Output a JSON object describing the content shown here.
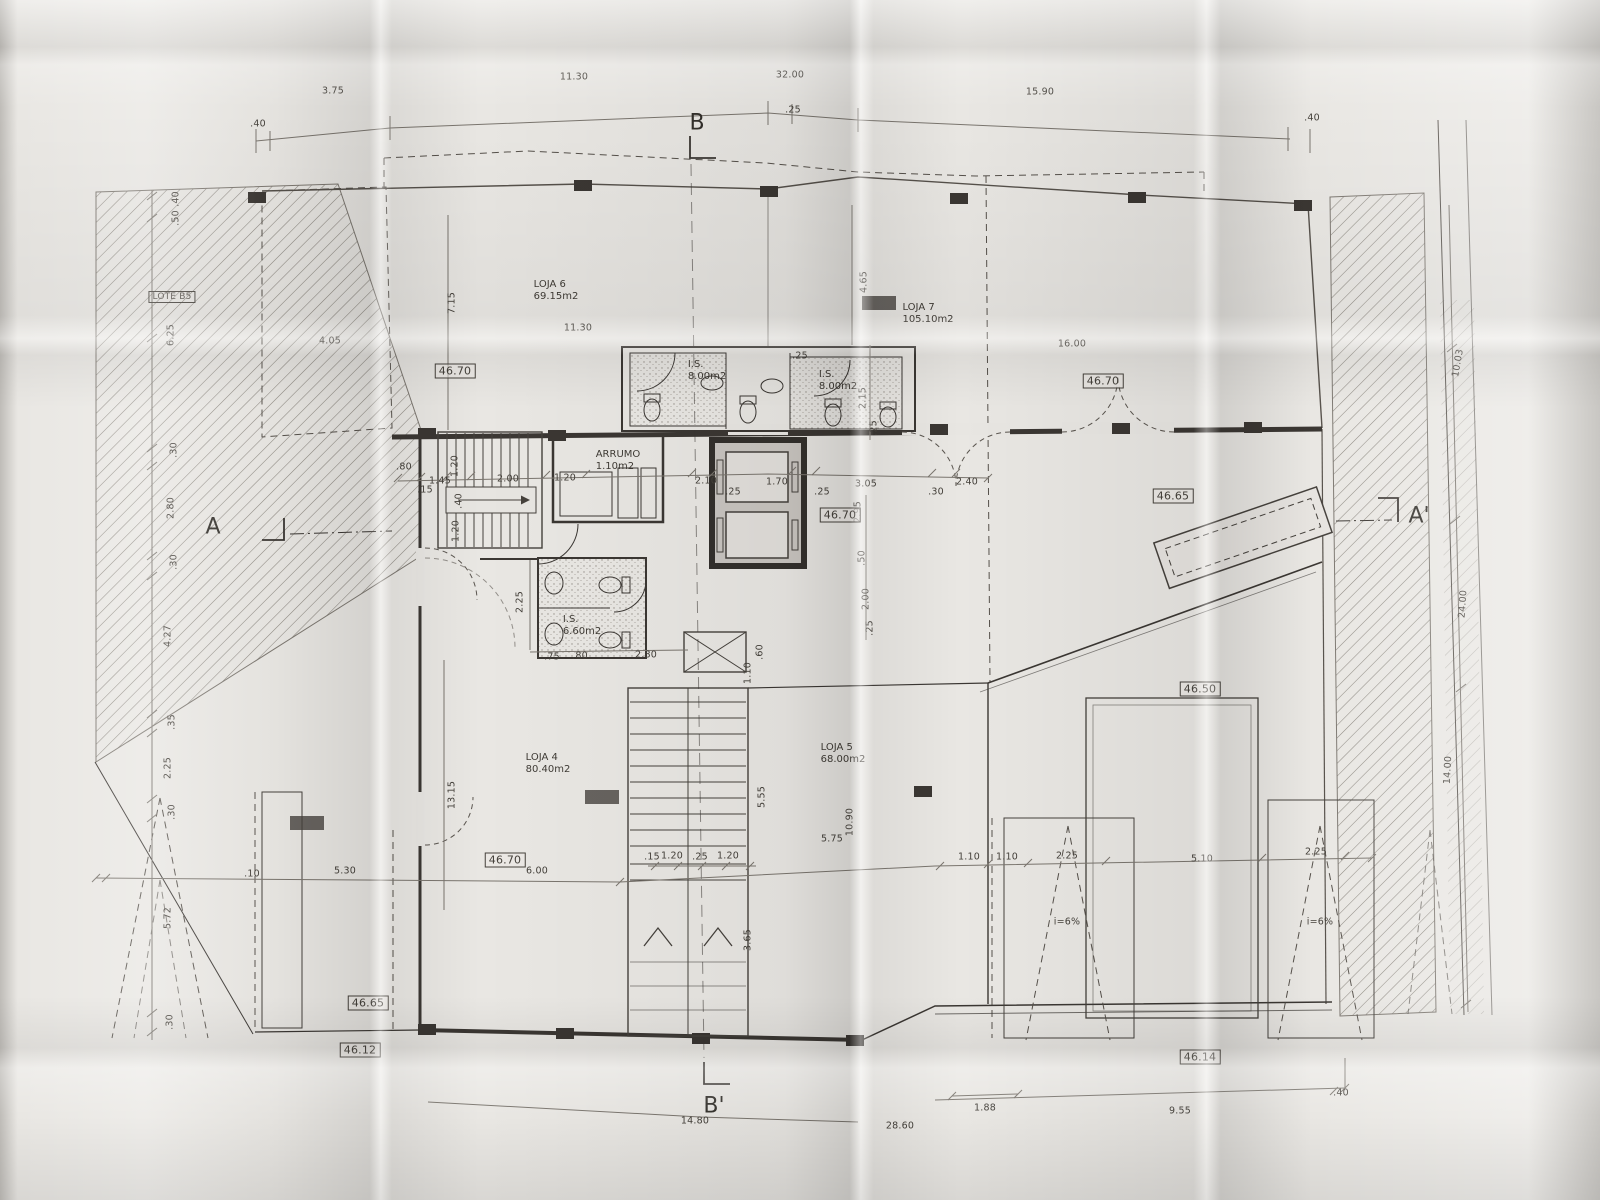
{
  "document": {
    "type": "architectural-floor-plan",
    "description": "Photographed fold-out blueprint, ground floor plan with shops (lojas), WCs, stairs, elevators and ramps"
  },
  "section_markers": [
    {
      "label": "B",
      "x": 697,
      "y": 123
    },
    {
      "label": "B'",
      "x": 714,
      "y": 1106
    },
    {
      "label": "A",
      "x": 213,
      "y": 527
    },
    {
      "label": "A'",
      "x": 1419,
      "y": 516
    }
  ],
  "lot_label": {
    "text": "LOTE B5",
    "x": 172,
    "y": 297
  },
  "room_labels": [
    {
      "name": "LOJA 6",
      "area": "69.15m2",
      "x": 556,
      "y": 291
    },
    {
      "name": "LOJA 7",
      "area": "105.10m2",
      "x": 928,
      "y": 314
    },
    {
      "name": "LOJA 4",
      "area": "80.40m2",
      "x": 548,
      "y": 764
    },
    {
      "name": "LOJA 5",
      "area": "68.00m2",
      "x": 843,
      "y": 754
    },
    {
      "name": "I.S.",
      "area": "8.00m2",
      "x": 707,
      "y": 371
    },
    {
      "name": "I.S.",
      "area": "8.00m2",
      "x": 838,
      "y": 381
    },
    {
      "name": "I.S.",
      "area": "6.60m2",
      "x": 582,
      "y": 626
    },
    {
      "name": "ARRUMO",
      "area": "1.10m2",
      "x": 618,
      "y": 461
    }
  ],
  "elevation_labels": [
    {
      "text": "46.70",
      "x": 455,
      "y": 371
    },
    {
      "text": "46.70",
      "x": 1103,
      "y": 381
    },
    {
      "text": "46.65",
      "x": 1173,
      "y": 496
    },
    {
      "text": "46.70",
      "x": 840,
      "y": 515
    },
    {
      "text": "46.50",
      "x": 1200,
      "y": 689
    },
    {
      "text": "46.70",
      "x": 505,
      "y": 860
    },
    {
      "text": "46.65",
      "x": 368,
      "y": 1003
    },
    {
      "text": "46.12",
      "x": 360,
      "y": 1050
    },
    {
      "text": "46.14",
      "x": 1200,
      "y": 1057
    }
  ],
  "slope_labels": [
    {
      "text": "i=6%",
      "x": 1067,
      "y": 922
    },
    {
      "text": "i=6%",
      "x": 1320,
      "y": 922
    }
  ],
  "dimensions": [
    {
      "t": ".40",
      "x": 258,
      "y": 124,
      "r": 0
    },
    {
      "t": "3.75",
      "x": 333,
      "y": 91,
      "r": 0
    },
    {
      "t": "11.30",
      "x": 574,
      "y": 77,
      "r": 0
    },
    {
      "t": "32.00",
      "x": 790,
      "y": 75,
      "r": 0
    },
    {
      "t": ".25",
      "x": 793,
      "y": 110,
      "r": 0
    },
    {
      "t": "15.90",
      "x": 1040,
      "y": 92,
      "r": 0
    },
    {
      "t": ".40",
      "x": 1312,
      "y": 118,
      "r": 0
    },
    {
      "t": ".40",
      "x": 176,
      "y": 199,
      "r": -90
    },
    {
      "t": ".50",
      "x": 176,
      "y": 218,
      "r": -90
    },
    {
      "t": "6.25",
      "x": 171,
      "y": 335,
      "r": -90
    },
    {
      "t": ".30",
      "x": 174,
      "y": 450,
      "r": -90
    },
    {
      "t": "2.80",
      "x": 171,
      "y": 508,
      "r": -90
    },
    {
      "t": ".30",
      "x": 174,
      "y": 562,
      "r": -90
    },
    {
      "t": "4.27",
      "x": 168,
      "y": 636,
      "r": -90
    },
    {
      "t": ".35",
      "x": 172,
      "y": 722,
      "r": -90
    },
    {
      "t": "2.25",
      "x": 168,
      "y": 768,
      "r": -90
    },
    {
      "t": ".30",
      "x": 172,
      "y": 812,
      "r": -90
    },
    {
      "t": "5.72",
      "x": 168,
      "y": 918,
      "r": -90
    },
    {
      "t": ".30",
      "x": 170,
      "y": 1022,
      "r": -90
    },
    {
      "t": "7.15",
      "x": 452,
      "y": 303,
      "r": -90
    },
    {
      "t": "4.05",
      "x": 330,
      "y": 341,
      "r": 0
    },
    {
      "t": "11.30",
      "x": 578,
      "y": 328,
      "r": 0
    },
    {
      "t": "4.65",
      "x": 864,
      "y": 282,
      "r": -90
    },
    {
      "t": "16.00",
      "x": 1072,
      "y": 344,
      "r": 0
    },
    {
      "t": ".25",
      "x": 800,
      "y": 356,
      "r": 0
    },
    {
      "t": "2.15",
      "x": 863,
      "y": 398,
      "r": -90
    },
    {
      "t": ".25",
      "x": 874,
      "y": 428,
      "r": -90
    },
    {
      "t": ".80",
      "x": 404,
      "y": 467,
      "r": 0
    },
    {
      "t": "1.45",
      "x": 440,
      "y": 481,
      "r": 0
    },
    {
      "t": ".15",
      "x": 425,
      "y": 490,
      "r": 0
    },
    {
      "t": "1.20",
      "x": 455,
      "y": 466,
      "r": -90
    },
    {
      "t": "2.00",
      "x": 508,
      "y": 479,
      "r": 0
    },
    {
      "t": ".40",
      "x": 459,
      "y": 501,
      "r": -90
    },
    {
      "t": "1.20",
      "x": 456,
      "y": 531,
      "r": -90
    },
    {
      "t": "1.20",
      "x": 565,
      "y": 478,
      "r": 0
    },
    {
      "t": "2.10",
      "x": 706,
      "y": 481,
      "r": 0
    },
    {
      "t": ".25",
      "x": 733,
      "y": 492,
      "r": 0
    },
    {
      "t": "1.70",
      "x": 777,
      "y": 482,
      "r": 0
    },
    {
      "t": ".25",
      "x": 822,
      "y": 492,
      "r": 0
    },
    {
      "t": "3.05",
      "x": 866,
      "y": 484,
      "r": 0
    },
    {
      "t": ".30",
      "x": 936,
      "y": 492,
      "r": 0
    },
    {
      "t": "2.40",
      "x": 967,
      "y": 482,
      "r": 0
    },
    {
      "t": "2.95",
      "x": 858,
      "y": 512,
      "r": -90
    },
    {
      "t": ".50",
      "x": 862,
      "y": 558,
      "r": -90
    },
    {
      "t": "2.00",
      "x": 866,
      "y": 599,
      "r": -90
    },
    {
      "t": ".25",
      "x": 870,
      "y": 628,
      "r": -90
    },
    {
      "t": "2.25",
      "x": 520,
      "y": 602,
      "r": -90
    },
    {
      "t": ".75",
      "x": 552,
      "y": 657,
      "r": 0
    },
    {
      "t": ".80",
      "x": 580,
      "y": 656,
      "r": 0
    },
    {
      "t": "2.80",
      "x": 646,
      "y": 655,
      "r": 0
    },
    {
      "t": ".60",
      "x": 760,
      "y": 652,
      "r": -90
    },
    {
      "t": "1.10",
      "x": 748,
      "y": 673,
      "r": -90
    },
    {
      "t": "5.55",
      "x": 762,
      "y": 797,
      "r": -90
    },
    {
      "t": "10.90",
      "x": 850,
      "y": 822,
      "r": -90
    },
    {
      "t": "5.75",
      "x": 832,
      "y": 839,
      "r": 0
    },
    {
      "t": "13.15",
      "x": 452,
      "y": 795,
      "r": -90
    },
    {
      "t": "3.65",
      "x": 748,
      "y": 940,
      "r": -90
    },
    {
      "t": ".15",
      "x": 652,
      "y": 857,
      "r": 0
    },
    {
      "t": "1.20",
      "x": 672,
      "y": 856,
      "r": 0
    },
    {
      "t": ".25",
      "x": 700,
      "y": 857,
      "r": 0
    },
    {
      "t": "1.20",
      "x": 728,
      "y": 856,
      "r": 0
    },
    {
      "t": "5.30",
      "x": 345,
      "y": 871,
      "r": 0
    },
    {
      "t": ".10",
      "x": 252,
      "y": 874,
      "r": 0
    },
    {
      "t": "6.00",
      "x": 537,
      "y": 871,
      "r": 0
    },
    {
      "t": "1.10",
      "x": 969,
      "y": 857,
      "r": 0
    },
    {
      "t": "1.10",
      "x": 1007,
      "y": 857,
      "r": 0
    },
    {
      "t": "2.25",
      "x": 1067,
      "y": 856,
      "r": 0
    },
    {
      "t": "5.10",
      "x": 1202,
      "y": 859,
      "r": 0
    },
    {
      "t": "2.25",
      "x": 1316,
      "y": 852,
      "r": 0
    },
    {
      "t": "14.80",
      "x": 695,
      "y": 1121,
      "r": 0
    },
    {
      "t": "28.60",
      "x": 900,
      "y": 1126,
      "r": 0
    },
    {
      "t": "1.88",
      "x": 985,
      "y": 1108,
      "r": 0
    },
    {
      "t": "9.55",
      "x": 1180,
      "y": 1111,
      "r": 0
    },
    {
      "t": ".40",
      "x": 1341,
      "y": 1093,
      "r": 0
    },
    {
      "t": "10.03",
      "x": 1458,
      "y": 363,
      "r": -80
    },
    {
      "t": "24.00",
      "x": 1463,
      "y": 604,
      "r": -86
    },
    {
      "t": "14.00",
      "x": 1448,
      "y": 770,
      "r": -87
    }
  ]
}
